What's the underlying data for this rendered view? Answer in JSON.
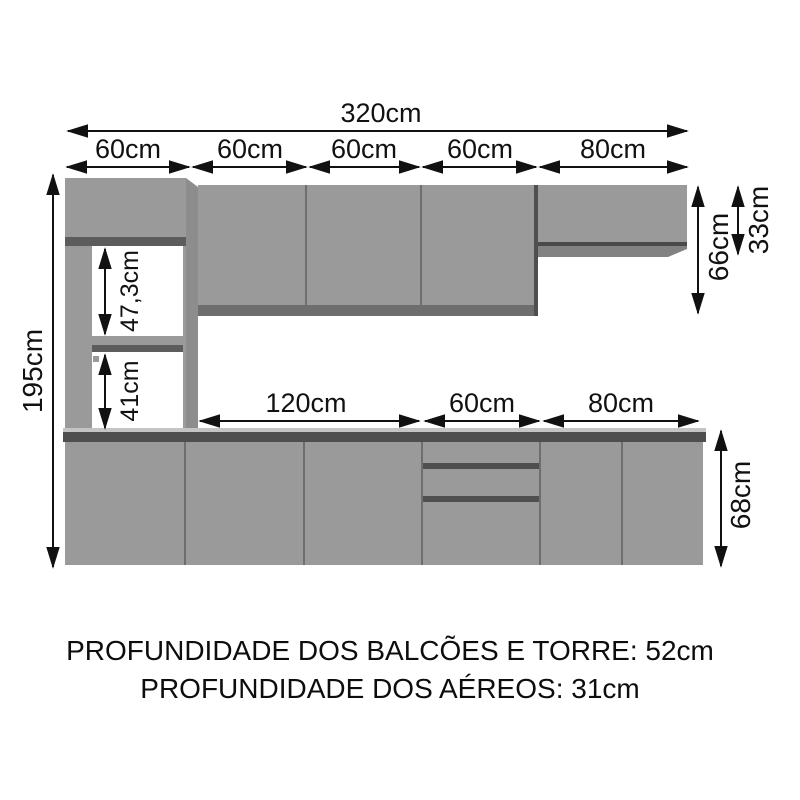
{
  "diagram": {
    "dims": {
      "total_width": "320cm",
      "segments_top": [
        "60cm",
        "60cm",
        "60cm",
        "60cm",
        "80cm"
      ],
      "total_height": "195cm",
      "tower_upper_shelf": "47,3cm",
      "tower_lower_shelf": "41cm",
      "aereo_tall_height": "66cm",
      "aereo_short_height": "33cm",
      "segments_base": [
        "120cm",
        "60cm",
        "80cm"
      ],
      "base_height": "68cm"
    },
    "footer": {
      "line1": "PROFUNDIDADE DOS BALCÕES E TORRE: 52cm",
      "line2": "PROFUNDIDADE DOS AÉREOS: 31cm"
    },
    "colors": {
      "cabinet": "#9a9a9a",
      "cabinet_shadow": "#5c5c5c",
      "dimension_lines": "#111111",
      "background": "#ffffff"
    }
  }
}
